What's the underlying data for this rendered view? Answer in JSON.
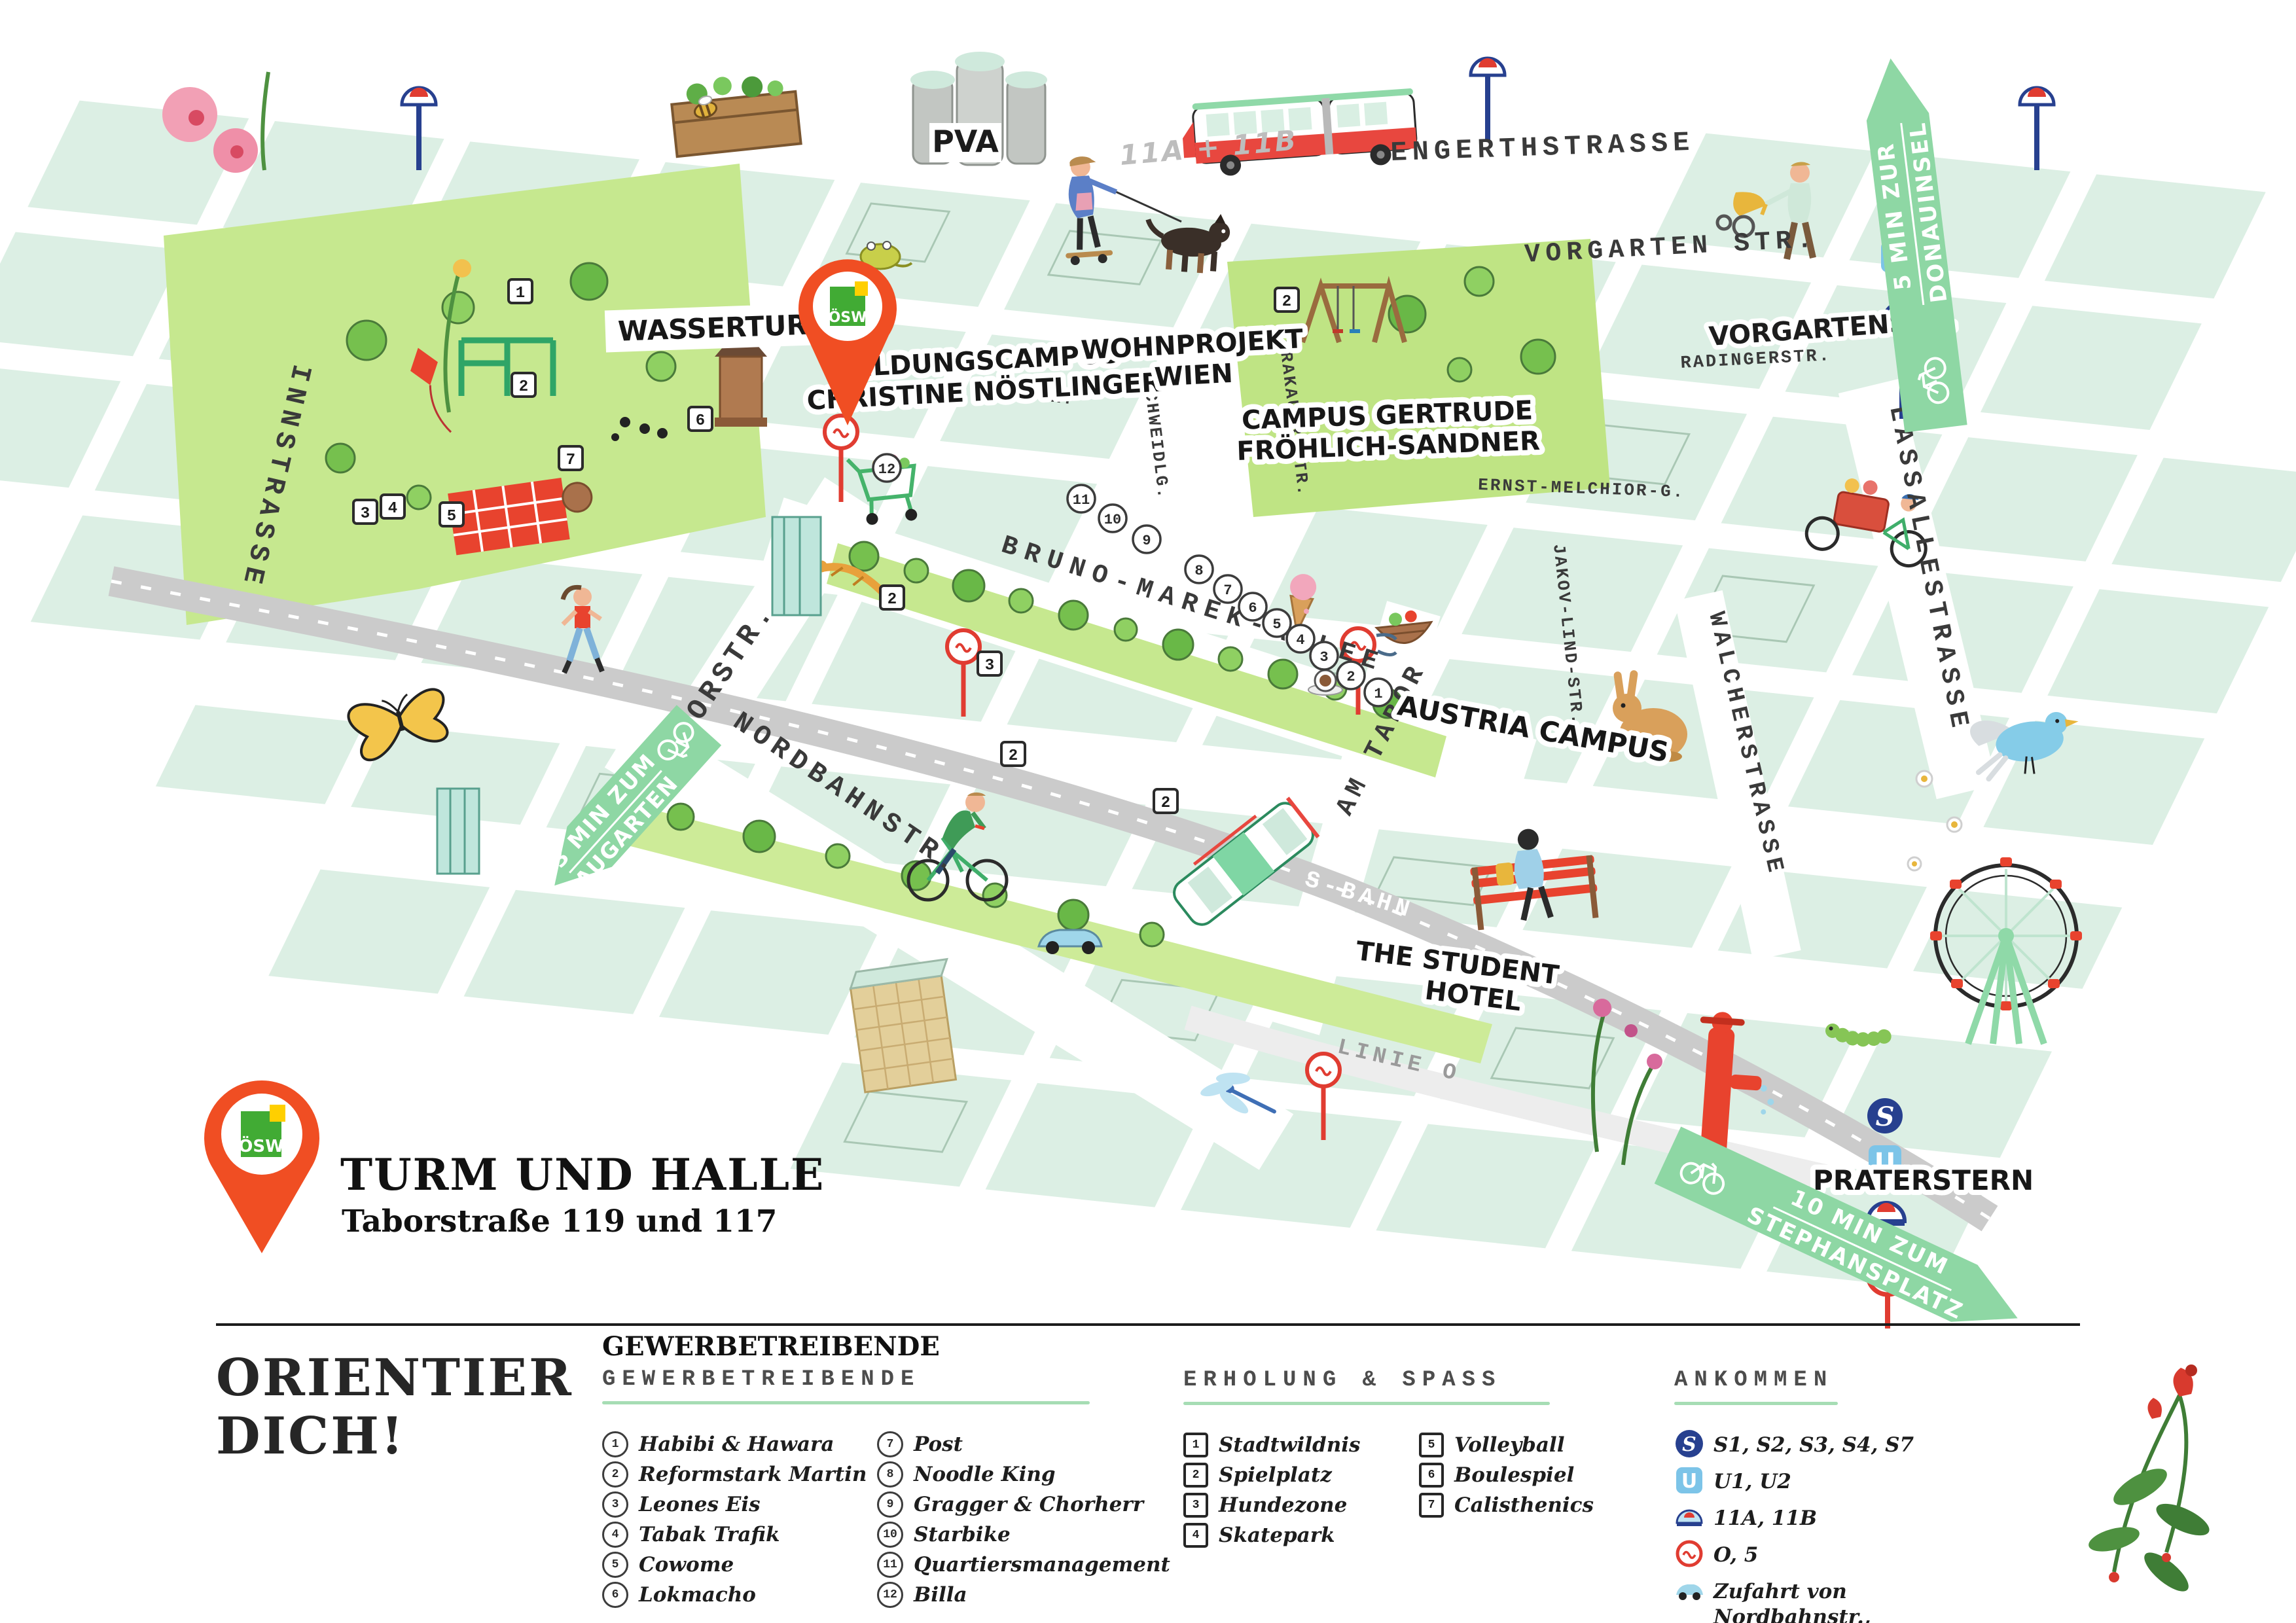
{
  "pin": {
    "logo": "ÖSW"
  },
  "title": {
    "name": "TURM UND HALLE",
    "address": "Taborstraße 119 und 117"
  },
  "map": {
    "streets": {
      "engerthstrasse": "ENGERTHSTRASSE",
      "vorgarten_str": "VORGARTEN STR.",
      "vorgartenstr": "VORGARTENSTR.",
      "radingerstr": "RADINGERSTR.",
      "innstrasse": "INNSTRASSE",
      "taborstr": "TABORSTR.",
      "bruno_marek_allee": "BRUNO-MAREK-ALLEE",
      "nordbahnstr": "NORDBAHNSTR.",
      "lassallestrasse": "LASSALLESTRASSE",
      "walcherstrasse": "WALCHERSTRASSE",
      "am_tabor": "AM TABOR",
      "schweidlg": "SCHWEIDLG.",
      "krakauer_str": "KRAKAUER STR.",
      "jakov_lind_str": "JAKOV-LIND-STR.",
      "ernst_melchior_g": "ERNST-MELCHIOR-G.",
      "leystr": "LEYSTR.",
      "linie_o": "LINIE O",
      "s_bahn": "S-BAHN",
      "bus_lines": "11A + 11B"
    },
    "places": {
      "pva": "PVA",
      "wasserturm": "WASSERTURM",
      "bildungscampus_1": "BILDUNGSCAMPUS",
      "bildungscampus_2": "CHRISTINE NÖSTLINGER",
      "wohnprojekt_1": "WOHNPROJEKT",
      "wohnprojekt_2": "WIEN",
      "campus_gertrude_1": "CAMPUS GERTRUDE",
      "campus_gertrude_2": "FRÖHLICH-SANDNER",
      "austria_campus": "AUSTRIA CAMPUS",
      "student_hotel_1": "THE STUDENT",
      "student_hotel_2": "HOTEL",
      "praterstern": "PRATERSTERN"
    },
    "banners": {
      "augarten_1": "3 MIN ZUM",
      "augarten_2": "AUGARTEN",
      "donauinsel_1": "5 MIN ZUR",
      "donauinsel_2": "DONAUINSEL",
      "stephansplatz_1": "10 MIN ZUM",
      "stephansplatz_2": "STEPHANSPLATZ"
    },
    "square_markers": [
      "1",
      "2",
      "7",
      "6",
      "3",
      "4",
      "5",
      "2",
      "2",
      "3",
      "2",
      "2"
    ],
    "circle_markers": [
      "12",
      "11",
      "10",
      "9",
      "8",
      "7",
      "6",
      "5",
      "4",
      "3",
      "2",
      "1"
    ],
    "transit_letters": {
      "s": "S",
      "u": "U"
    }
  },
  "legend": {
    "headline_1": "ORIENTIER",
    "headline_2": "DICH!",
    "gewerbe": {
      "overtitle": "GEWERBETREIBENDE",
      "heading": "GEWERBETREIBENDE",
      "items": [
        {
          "num": "1",
          "label": "Habibi & Hawara"
        },
        {
          "num": "2",
          "label": "Reformstark Martin"
        },
        {
          "num": "3",
          "label": "Leones Eis"
        },
        {
          "num": "4",
          "label": "Tabak Trafik"
        },
        {
          "num": "5",
          "label": "Cowome"
        },
        {
          "num": "6",
          "label": "Lokmacho"
        },
        {
          "num": "7",
          "label": "Post"
        },
        {
          "num": "8",
          "label": "Noodle King"
        },
        {
          "num": "9",
          "label": "Gragger & Chorherr"
        },
        {
          "num": "10",
          "label": "Starbike"
        },
        {
          "num": "11",
          "label": "Quartiersmanagement"
        },
        {
          "num": "12",
          "label": "Billa"
        }
      ]
    },
    "erholung": {
      "heading": "ERHOLUNG & SPASS",
      "items": [
        {
          "num": "1",
          "label": "Stadtwildnis"
        },
        {
          "num": "2",
          "label": "Spielplatz"
        },
        {
          "num": "3",
          "label": "Hundezone"
        },
        {
          "num": "4",
          "label": "Skatepark"
        },
        {
          "num": "5",
          "label": "Volleyball"
        },
        {
          "num": "6",
          "label": "Boulespiel"
        },
        {
          "num": "7",
          "label": "Calisthenics"
        }
      ]
    },
    "ankommen": {
      "heading": "ANKOMMEN",
      "items": [
        {
          "icon": "sbahn",
          "label": "S1, S2, S3, S4, S7"
        },
        {
          "icon": "ubahn",
          "label": "U1, U2"
        },
        {
          "icon": "bus",
          "label": "11A, 11B"
        },
        {
          "icon": "tram",
          "label": "O, 5"
        },
        {
          "icon": "car",
          "label": "Zufahrt von Nordbahnstr., Lassallestr. und Vorgartenstr."
        }
      ]
    }
  },
  "colors": {
    "pin_red": "#f04e23",
    "banner_green": "#8ed7a4",
    "park_green": "#c6e88f",
    "block_mint": "#dcefe4",
    "sbahn_blue": "#27408f",
    "ubahn_blue": "#7cc4e8",
    "tram_red": "#e03c31"
  }
}
